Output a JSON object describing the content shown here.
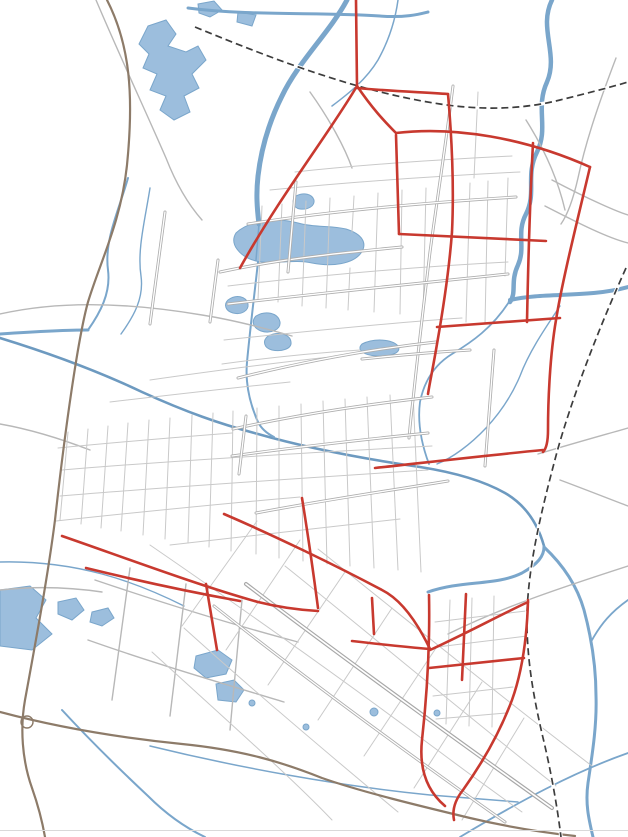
{
  "map": {
    "colors": {
      "planned_road_red": "#c8392f",
      "water_blue": "#7aa6cb",
      "water_fill": "#9cbedd",
      "highway_brown": "#8d7b69",
      "railway_black": "#3d3d3d",
      "road_gray": "#aeaeae",
      "label_color": "#2f3540"
    },
    "road_labels": [
      {
        "text": "高铁站前大道",
        "x": 492,
        "y": 126,
        "rotate": 12
      },
      {
        "text": "东湖路",
        "x": 452,
        "y": 103,
        "vertical": true,
        "gap": 1.3
      },
      {
        "text": "—",
        "x": 444,
        "y": 154,
        "rotate": 75,
        "size": 9
      },
      {
        "text": "天门大道",
        "x": 435,
        "y": 172,
        "vertical": true,
        "gap": 1.35
      },
      {
        "text": "西湖路",
        "x": 291,
        "y": 201,
        "vertical": true,
        "gap": 1.3
      },
      {
        "text": "环北大道",
        "x": 347,
        "y": 212,
        "rotate": -4,
        "ls": 2
      },
      {
        "text": "北湖大道",
        "x": 283,
        "y": 255,
        "rotate": -10
      },
      {
        "text": "陆羽大道",
        "x": 337,
        "y": 290,
        "rotate": -4,
        "ls": 1
      },
      {
        "text": "江汉路",
        "x": 157,
        "y": 241,
        "vertical": true,
        "gap": 1.7
      },
      {
        "text": "状元路",
        "x": 212,
        "y": 271,
        "vertical": true,
        "gap": 1.4,
        "rotate": -6
      },
      {
        "text": "随岳高速",
        "x": 98,
        "y": 224,
        "vertical": true,
        "gap": 1.55,
        "rotate": -8
      },
      {
        "text": "国道G348",
        "x": 57,
        "y": 300,
        "rotate": -7
      },
      {
        "text": "竟九路",
        "x": 464,
        "y": 247,
        "vertical": true,
        "gap": 1.5
      },
      {
        "text": "东绕城路",
        "x": 557,
        "y": 254,
        "vertical": true,
        "gap": 1.35,
        "rotate": -3
      },
      {
        "text": "人民大道",
        "x": 303,
        "y": 357,
        "rotate": -8,
        "ls": 1
      },
      {
        "text": "东江大道",
        "x": 401,
        "y": 353,
        "rotate": -3
      },
      {
        "text": "杨林河路",
        "x": 493,
        "y": 374,
        "vertical": true,
        "gap": 1.6,
        "rotate": -3
      },
      {
        "text": "钟惺大道",
        "x": 293,
        "y": 413,
        "rotate": -10,
        "ls": 1
      },
      {
        "text": "汇侨大道",
        "x": 290,
        "y": 447,
        "rotate": -4,
        "ls": 1
      },
      {
        "text": "接官路",
        "x": 241,
        "y": 426,
        "vertical": true,
        "gap": 1.35
      },
      {
        "text": "江汉平原货运铁路",
        "x": 591,
        "y": 370,
        "vertical": true,
        "gap": 1.15,
        "rotate": -12,
        "size": 8.5
      },
      {
        "text": "省道S345",
        "x": 597,
        "y": 435,
        "rotate": -6
      },
      {
        "text": "创业大道",
        "x": 300,
        "y": 501,
        "rotate": -8,
        "ls": 1
      },
      {
        "text": "发展大道",
        "x": 327,
        "y": 558,
        "rotate": 14,
        "ls": 1
      },
      {
        "text": "省道S214",
        "x": 31,
        "y": 588,
        "rotate": -4
      },
      {
        "text": "国道G348",
        "x": 588,
        "y": 583,
        "rotate": -17
      },
      {
        "text": "竟东路",
        "x": 417,
        "y": 624,
        "vertical": true,
        "gap": 1.5
      },
      {
        "text": "天仙大道",
        "x": 371,
        "y": 674,
        "rotate": 30,
        "ls": 2
      },
      {
        "text": "南湖大道",
        "x": 328,
        "y": 694,
        "rotate": 30,
        "ls": 1
      },
      {
        "text": "武天高速",
        "x": 224,
        "y": 750,
        "rotate": 7,
        "ls": 7
      }
    ],
    "stations": [
      {
        "x": 526,
        "y": 109,
        "tag": false
      },
      {
        "x": 534,
        "y": 690,
        "tag": true
      }
    ],
    "watermark": {
      "title": "大天门论坛",
      "subtitle": "bbs.datianmen.com",
      "rotate": -8,
      "positions": [
        {
          "x": 305,
          "y": 158
        },
        {
          "x": 300,
          "y": 421
        },
        {
          "x": 302,
          "y": 701
        },
        {
          "x": 640,
          "y": 112
        },
        {
          "x": 640,
          "y": 385
        },
        {
          "x": 640,
          "y": 652
        }
      ]
    }
  }
}
